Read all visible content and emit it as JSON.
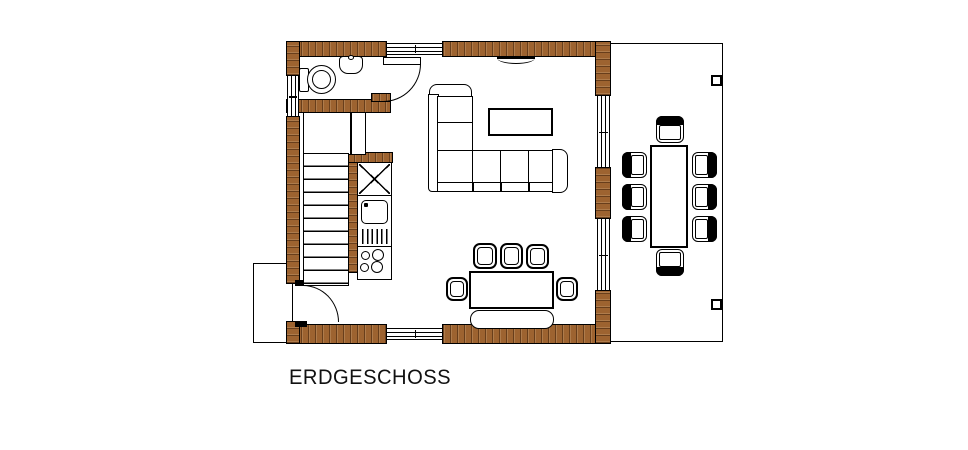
{
  "title": "ERDGESCHOSS",
  "colors": {
    "wall_wood": "#9d6330",
    "wall_wood_dark": "#5a3415",
    "outline": "#000000",
    "background": "#ffffff"
  }
}
